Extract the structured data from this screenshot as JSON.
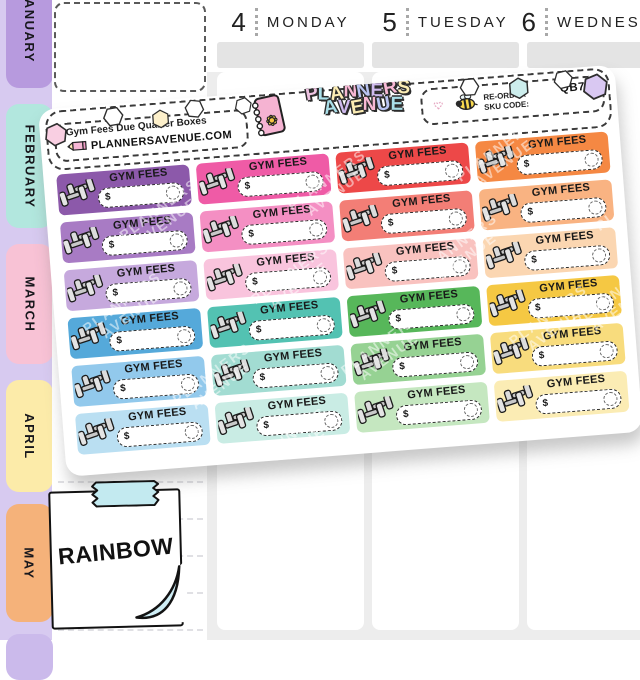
{
  "page": {
    "background": "#ffffff",
    "side_strip_color": "#d7caf0",
    "grid_bg": "#ededed",
    "allday_bg": "#e4e4e4"
  },
  "planner": {
    "tabs": [
      {
        "label": "JANUARY",
        "color": "#b79ade"
      },
      {
        "label": "FEBRUARY",
        "color": "#b2e7de"
      },
      {
        "label": "MARCH",
        "color": "#f8c2d5"
      },
      {
        "label": "APRIL",
        "color": "#fceba9"
      },
      {
        "label": "MAY",
        "color": "#f5b27a"
      },
      {
        "label": "",
        "color": "#cbbaeb"
      }
    ],
    "days": [
      {
        "number": "4",
        "name": "MONDAY"
      },
      {
        "number": "5",
        "name": "TUESDAY"
      },
      {
        "number": "6",
        "name": "WEDNESDAY"
      }
    ]
  },
  "sheet": {
    "product_label": "Gym Fees Due Quarter Boxes",
    "website": "PLANNERSAVENUE.COM",
    "brand": {
      "line1": "PLANNERS",
      "line2": "AVENUE",
      "colors1": [
        "#eec3e2",
        "#aadfe9",
        "#fcedb4",
        "#f7b8d4",
        "#b9c4f2",
        "#cfbaee",
        "#f7b8d4",
        "#fcedb4"
      ],
      "colors2": [
        "#aadfe9",
        "#cfbaee",
        "#fcedb4",
        "#f7b8d4",
        "#b9c4f2",
        "#aadfe9"
      ]
    },
    "reorder_line1": "RE-ORDER",
    "reorder_line2": "SKU CODE:",
    "sku": "QB77",
    "watermark": {
      "line1": "PLANNERS",
      "line2": "AVENUE"
    },
    "sticker": {
      "label": "GYM FEES",
      "currency": "$"
    },
    "grid_colors": [
      [
        "#8c59aa",
        "#ef5ba6",
        "#ed4848",
        "#f58843"
      ],
      [
        "#a87bc4",
        "#f48fc3",
        "#f37e76",
        "#f9b382"
      ],
      [
        "#c6a9dd",
        "#f9c4dd",
        "#f9c2bf",
        "#fbd6b1"
      ],
      [
        "#55a9da",
        "#53c2b2",
        "#57b75a",
        "#f5c843"
      ],
      [
        "#92c9ec",
        "#a2dcd2",
        "#96d293",
        "#f8dc7d"
      ],
      [
        "#badff2",
        "#c9ece4",
        "#c5e7c0",
        "#fbecb4"
      ]
    ],
    "hexagons": [
      {
        "x": 4,
        "y": 14,
        "s": 24,
        "r": 10,
        "c": "#f9cfe2"
      },
      {
        "x": 64,
        "y": 2,
        "s": 21,
        "r": 25,
        "c": "#ffffff"
      },
      {
        "x": 112,
        "y": 9,
        "s": 19,
        "r": 0,
        "c": "#fdf0cb"
      },
      {
        "x": 146,
        "y": 1,
        "s": 20,
        "r": 40,
        "c": "#ffffff"
      },
      {
        "x": 196,
        "y": 3,
        "s": 18,
        "r": 15,
        "c": "#ffffff"
      },
      {
        "x": 422,
        "y": 1,
        "s": 20,
        "r": 30,
        "c": "#ffffff"
      },
      {
        "x": 470,
        "y": 5,
        "s": 22,
        "r": 0,
        "c": "#cdeeed"
      },
      {
        "x": 516,
        "y": 1,
        "s": 20,
        "r": 20,
        "c": "#ffffff"
      },
      {
        "x": 544,
        "y": 7,
        "s": 27,
        "r": 12,
        "c": "#d9c8f2"
      }
    ]
  },
  "note": {
    "label": "RAINBOW",
    "tape_color": "#c3eaf0",
    "curl_color": "#cfeef6"
  }
}
